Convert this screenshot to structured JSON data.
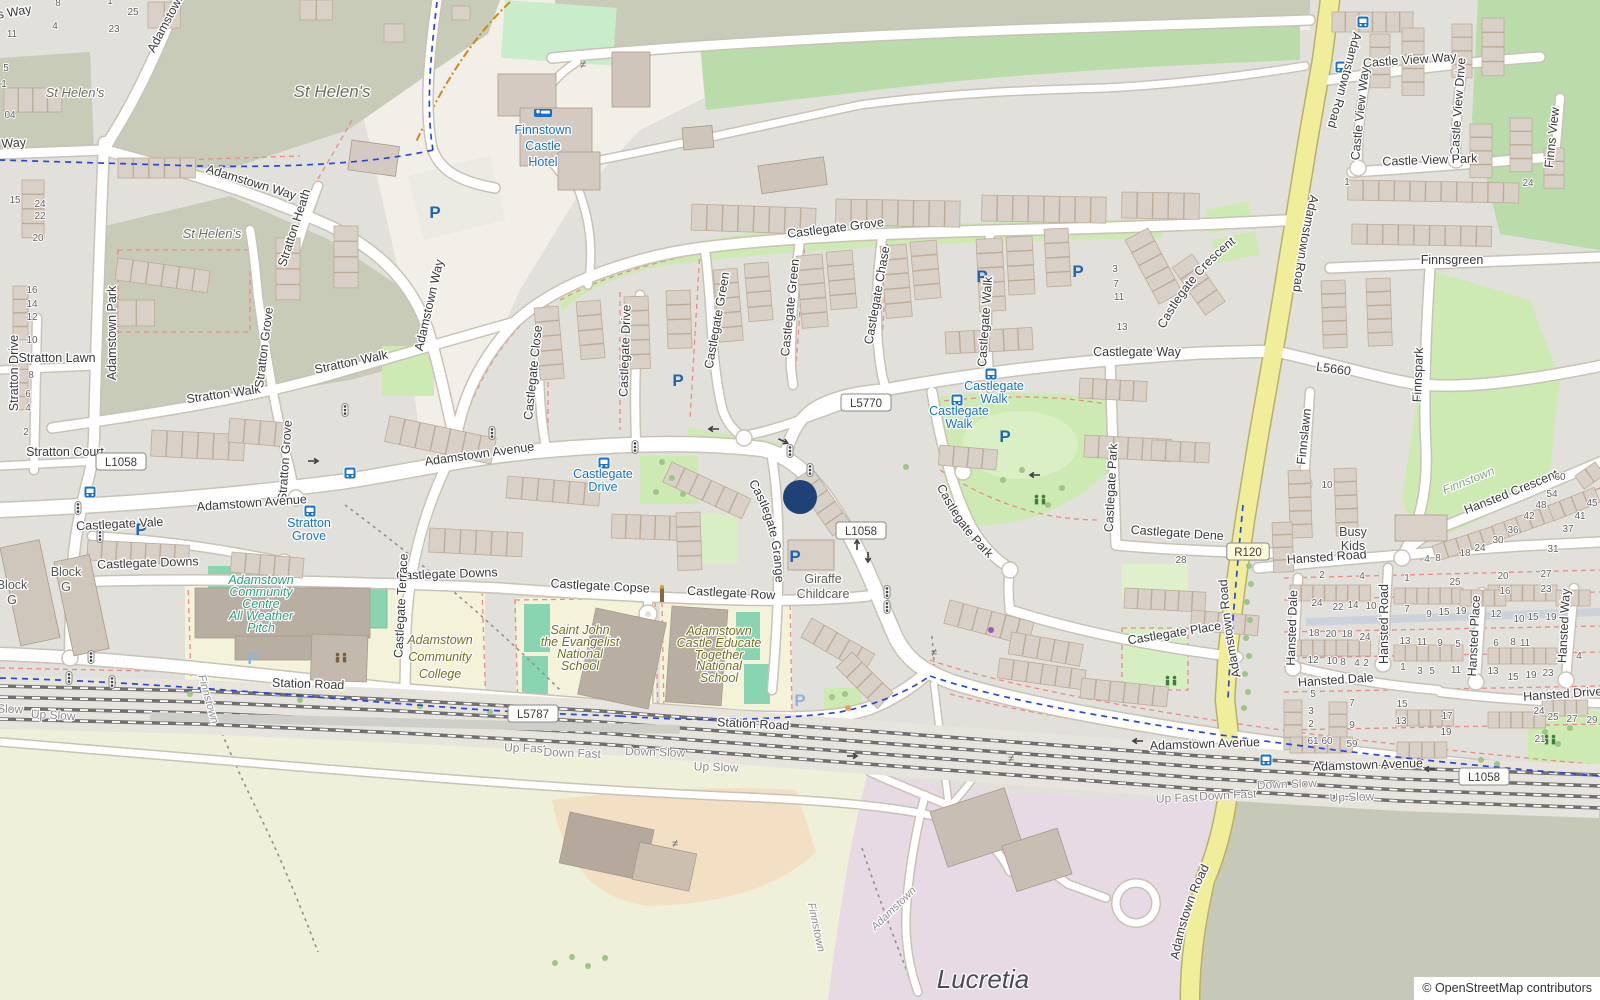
{
  "map": {
    "attribution": "© OpenStreetMap contributors",
    "marker": {
      "x": 800,
      "y": 497,
      "r": 17,
      "color": "#1e4177"
    },
    "colors": {
      "residential": "#e2e0da",
      "base": "#f2efe8",
      "olive_green": "#c7cbb7",
      "wood_green": "#b9dcaa",
      "park_green": "#cdeab3",
      "pitch_teal": "#89d4b1",
      "school_yellow": "#f4f2d9",
      "construction_purple": "#e7dae5",
      "field": "#eff0da",
      "olive_gray": "#c7c9b8",
      "orange_area": "#f3dfc3",
      "road_yellow": "#f1ee9b",
      "building": "#d9d0c8",
      "transit_blue": "#1673c2",
      "hotel_blue": "#1a6fc4",
      "parking_blue": "#2065b0",
      "marker_navy": "#1e4177",
      "red_dash": "#e98b87",
      "cycle_blue": "#2a47d8"
    },
    "road_refs": [
      [
        "L1058",
        121,
        462,
        "w"
      ],
      [
        "L1058",
        861,
        531,
        "w"
      ],
      [
        "L1058",
        1484,
        777,
        "w"
      ],
      [
        "L5770",
        866,
        403,
        "w"
      ],
      [
        "L5787",
        533,
        714,
        "w"
      ],
      [
        "R120",
        1248,
        552,
        "y"
      ]
    ],
    "street_labels": [
      [
        "'s Way",
        14,
        16,
        -10
      ],
      [
        "Way",
        14,
        147,
        -4
      ],
      [
        "Adamstown Way",
        250,
        186,
        17
      ],
      [
        "Adamstown Way",
        176,
        12,
        -62
      ],
      [
        "Adamstown Way",
        433,
        306,
        -77
      ],
      [
        "Stratton Heath",
        298,
        229,
        -72
      ],
      [
        "Stratton Drive",
        18,
        373,
        -90
      ],
      [
        "Stratton Lawn",
        57,
        362,
        0
      ],
      [
        "Stratton Court",
        65,
        456,
        0
      ],
      [
        "Adamstown Park",
        116,
        333,
        -90
      ],
      [
        "Stratton Walk",
        224,
        398,
        -8
      ],
      [
        "Stratton Walk",
        352,
        366,
        -12
      ],
      [
        "Stratton Grove",
        268,
        348,
        -83
      ],
      [
        "Stratton Grove",
        289,
        461,
        -86
      ],
      [
        "Castlegate Grove",
        836,
        232,
        -7
      ],
      [
        "Castlegate Close",
        537,
        373,
        -84
      ],
      [
        "Castlegate Drive",
        629,
        351,
        -88
      ],
      [
        "Castlegate Green",
        721,
        321,
        -80
      ],
      [
        "Castlegate Green",
        794,
        308,
        -84
      ],
      [
        "Castlegate Chase",
        881,
        296,
        -80
      ],
      [
        "Castlegate Walk",
        989,
        322,
        -86
      ],
      [
        "Castlegate Way",
        1137,
        356,
        0
      ],
      [
        "L5660",
        1333,
        373,
        8
      ],
      [
        "Castle View Way",
        1410,
        64,
        -4
      ],
      [
        "Castle View Way",
        1364,
        114,
        -84
      ],
      [
        "Castle View Drive",
        1462,
        107,
        -86
      ],
      [
        "Castle View Park",
        1430,
        164,
        -2
      ],
      [
        "Finns View",
        1556,
        138,
        -84
      ],
      [
        "Finnsgreen",
        1452,
        264,
        0
      ],
      [
        "Finnspark",
        1422,
        375,
        -88
      ],
      [
        "Finnslawn",
        1308,
        437,
        -84
      ],
      [
        "Hansted Road",
        1327,
        561,
        -4
      ],
      [
        "Hansted Road",
        1388,
        624,
        -90
      ],
      [
        "Hansted Dale",
        1296,
        628,
        -88
      ],
      [
        "Hansted Dale",
        1336,
        684,
        -4
      ],
      [
        "Hansted Place",
        1478,
        636,
        -87
      ],
      [
        "Hansted Way",
        1568,
        626,
        -87
      ],
      [
        "Hansted Drive",
        1563,
        698,
        -4
      ],
      [
        "Castlegate Vale",
        120,
        528,
        -3
      ],
      [
        "Castlegate Downs",
        148,
        567,
        -2
      ],
      [
        "Castlegate Downs",
        447,
        578,
        -2
      ],
      [
        "Castlegate Terrace",
        405,
        606,
        -87
      ],
      [
        "Castlegate Copse",
        600,
        590,
        3
      ],
      [
        "Castlegate Row",
        731,
        597,
        3
      ],
      [
        "Castlegate Park",
        1115,
        488,
        -87
      ],
      [
        "Castlegate Dene",
        1177,
        537,
        4
      ],
      [
        "Castlegate Place",
        1175,
        637,
        -9
      ],
      [
        "Adamstown Avenue",
        252,
        507,
        -4
      ],
      [
        "Adamstown Avenue",
        480,
        458,
        -8
      ],
      [
        "Adamstown Avenue",
        1205,
        748,
        -2
      ],
      [
        "Adamstown Avenue",
        1368,
        769,
        -2
      ],
      [
        "Station Road",
        308,
        688,
        2
      ],
      [
        "Station Road",
        753,
        728,
        3
      ]
    ],
    "curved_labels": [
      [
        "Castlegate Grange",
        "M 735,464 C 762,498 777,534 776,606"
      ],
      [
        "Castlegate Crescent",
        "M 1160,338 C 1180,296 1207,263 1244,237"
      ],
      [
        "Castlegate Park",
        "M 928,468 C 947,512 968,543 1004,572"
      ],
      [
        "Hansted Crescent",
        "M 1424,530 C 1492,505 1549,482 1600,459"
      ],
      [
        "Adamstown Road",
        "M 1355,26 C 1346,62 1337,96 1326,132"
      ],
      [
        "Adamstown Road",
        "M 1313,184 C 1303,224 1296,263 1292,302"
      ],
      [
        "Adamstown Road",
        "M 1241,678 C 1233,642 1229,611 1227,578"
      ],
      [
        "Adamstown Road",
        "M 1177,970 C 1183,928 1195,893 1214,858"
      ]
    ],
    "place_labels": [
      [
        "St Helen's",
        75,
        97,
        0,
        13,
        "#6d6d62"
      ],
      [
        "St Helen's",
        332,
        97,
        0,
        17,
        "#6d6d62"
      ],
      [
        "St Helen's",
        212,
        238,
        0,
        13,
        "#6d6d62"
      ],
      [
        "Finnstown",
        1470,
        484,
        -22,
        12,
        "#8ba386"
      ],
      [
        "Finnstown",
        205,
        700,
        74,
        11,
        "#8c8c8c"
      ],
      [
        "Adamstown",
        896,
        911,
        -44,
        11,
        "#8c8c8c"
      ],
      [
        "Finnstown",
        813,
        928,
        78,
        11,
        "#8c8c8c"
      ],
      [
        "Lucretia",
        983,
        988,
        0,
        26,
        "#4a4a58"
      ]
    ],
    "poi_labels": [
      {
        "lines": [
          "Finnstown",
          "Castle",
          "Hotel"
        ],
        "x": 543,
        "ys": [
          134,
          150,
          166
        ],
        "color": "#1a6fc4",
        "icon": "bed",
        "ix": 543,
        "iy": 114
      },
      {
        "lines": [
          "Giraffe",
          "Childcare"
        ],
        "x": 823,
        "ys": [
          583,
          598
        ],
        "color": "#5d5d55"
      },
      {
        "lines": [
          "Busy",
          "Kids"
        ],
        "x": 1353,
        "ys": [
          536,
          550
        ],
        "color": "#454545"
      },
      {
        "lines": [
          "Block",
          "G"
        ],
        "x": 12,
        "ys": [
          589,
          604
        ],
        "color": "#555555"
      },
      {
        "lines": [
          "Block",
          "G"
        ],
        "x": 66,
        "ys": [
          576,
          591
        ],
        "color": "#555555"
      }
    ],
    "school_labels": [
      {
        "lines": [
          "Adamstown",
          "Community",
          "College"
        ],
        "x": 440,
        "ys": [
          644,
          661,
          678
        ],
        "color": "#71711f"
      },
      {
        "lines": [
          "Saint John",
          "the Evangelist",
          "National",
          "School"
        ],
        "x": 580,
        "ys": [
          634,
          646,
          658,
          670
        ],
        "color": "#71711f"
      },
      {
        "lines": [
          "Adamstown",
          "Castle Educate",
          "Together",
          "National",
          "School"
        ],
        "x": 719,
        "ys": [
          635,
          647,
          659,
          670,
          682
        ],
        "color": "#71711f"
      },
      {
        "lines": [
          "Adamstown",
          "Community",
          "Centre",
          "All Weather",
          "Pitch"
        ],
        "x": 261,
        "ys": [
          584,
          596,
          608,
          620,
          632
        ],
        "color": "#2f9f7f"
      }
    ],
    "transit_stops": [
      {
        "lines": [
          "Castlegate",
          "Walk"
        ],
        "x": 994,
        "ys": [
          390,
          403
        ],
        "icon": [
          991,
          374
        ]
      },
      {
        "lines": [
          "Castlegate",
          "Walk"
        ],
        "x": 959,
        "ys": [
          415,
          428
        ],
        "icon": [
          957,
          400
        ]
      },
      {
        "lines": [
          "Castlegate",
          "Drive"
        ],
        "x": 603,
        "ys": [
          478,
          491
        ],
        "icon": [
          604,
          463
        ]
      },
      {
        "lines": [
          "Stratton",
          "Grove"
        ],
        "x": 309,
        "ys": [
          527,
          540
        ],
        "icon": [
          310,
          511
        ]
      }
    ],
    "bus_icons": [
      [
        350,
        473
      ],
      [
        90,
        492
      ],
      [
        1363,
        22
      ],
      [
        1341,
        67
      ],
      [
        1266,
        760
      ]
    ],
    "railway_labels": [
      [
        "Up Fast",
        525,
        752,
        2
      ],
      [
        "Down Fast",
        572,
        757,
        2
      ],
      [
        "Down Slow",
        655,
        756,
        2
      ],
      [
        "Up Slow",
        716,
        771,
        2
      ],
      [
        "Slow",
        10,
        713,
        2
      ],
      [
        "Up Slow",
        53,
        719,
        3
      ],
      [
        "Up Fast",
        1177,
        802,
        -2
      ],
      [
        "Down Fast",
        1228,
        799,
        -3
      ],
      [
        "Down Slow",
        1287,
        788,
        -2
      ],
      [
        "Up Slow",
        1352,
        801,
        -2
      ]
    ],
    "house_numbers": [
      [
        "8",
        58,
        6
      ],
      [
        "1",
        110,
        4
      ],
      [
        "25",
        133,
        15
      ],
      [
        "4",
        55,
        29
      ],
      [
        "23",
        114,
        32
      ],
      [
        "11",
        12,
        37
      ],
      [
        "5",
        6,
        71
      ],
      [
        "1",
        4,
        87
      ],
      [
        "04",
        10,
        118
      ],
      [
        "15",
        15,
        203
      ],
      [
        "24",
        40,
        207
      ],
      [
        "22",
        40,
        219
      ],
      [
        "20",
        38,
        241
      ],
      [
        "16",
        32,
        293
      ],
      [
        "14",
        32,
        307
      ],
      [
        "12",
        32,
        320
      ],
      [
        "10",
        32,
        343
      ],
      [
        "8",
        31,
        378
      ],
      [
        "6",
        28,
        397
      ],
      [
        "4",
        28,
        411
      ],
      [
        "2",
        26,
        435
      ],
      [
        "1",
        1347,
        185
      ],
      [
        "24",
        1528,
        186
      ],
      [
        "3",
        1115,
        272
      ],
      [
        "7",
        1116,
        287
      ],
      [
        "11",
        1119,
        300
      ],
      [
        "13",
        1122,
        330
      ],
      [
        "28",
        1181,
        563
      ],
      [
        "10",
        1327,
        488
      ],
      [
        "60",
        1560,
        480
      ],
      [
        "54",
        1552,
        497
      ],
      [
        "45",
        1592,
        506
      ],
      [
        "48",
        1541,
        508
      ],
      [
        "42",
        1529,
        519
      ],
      [
        "41",
        1580,
        519
      ],
      [
        "37",
        1568,
        532
      ],
      [
        "36",
        1513,
        533
      ],
      [
        "30",
        1498,
        543
      ],
      [
        "31",
        1553,
        552
      ],
      [
        "24",
        1480,
        551
      ],
      [
        "18",
        1465,
        556
      ],
      [
        "8",
        1438,
        561
      ],
      [
        "4",
        1427,
        562
      ],
      [
        "2",
        1322,
        578
      ],
      [
        "4",
        1362,
        579
      ],
      [
        "1",
        1407,
        581
      ],
      [
        "25",
        1455,
        585
      ],
      [
        "20",
        1503,
        579
      ],
      [
        "27",
        1546,
        577
      ],
      [
        "16",
        1505,
        594
      ],
      [
        "23",
        1546,
        592
      ],
      [
        "24",
        1317,
        606
      ],
      [
        "22",
        1338,
        610
      ],
      [
        "14",
        1353,
        608
      ],
      [
        "10",
        1371,
        609
      ],
      [
        "7",
        1407,
        612
      ],
      [
        "9",
        1429,
        617
      ],
      [
        "15",
        1444,
        615
      ],
      [
        "19",
        1461,
        614
      ],
      [
        "12",
        1496,
        617
      ],
      [
        "10",
        1519,
        622
      ],
      [
        "15",
        1533,
        620
      ],
      [
        "19",
        1551,
        620
      ],
      [
        "18",
        1314,
        636
      ],
      [
        "20",
        1331,
        637
      ],
      [
        "18",
        1347,
        637
      ],
      [
        "24",
        1365,
        640
      ],
      [
        "13",
        1405,
        644
      ],
      [
        "11",
        1422,
        645
      ],
      [
        "9",
        1440,
        646
      ],
      [
        "5",
        1458,
        647
      ],
      [
        "6",
        1496,
        646
      ],
      [
        "8",
        1513,
        645
      ],
      [
        "11",
        1525,
        646
      ],
      [
        "12",
        1313,
        663
      ],
      [
        "10",
        1332,
        664
      ],
      [
        "8",
        1343,
        665
      ],
      [
        "4",
        1357,
        666
      ],
      [
        "2",
        1366,
        666
      ],
      [
        "1",
        1403,
        670
      ],
      [
        "3",
        1420,
        674
      ],
      [
        "5",
        1432,
        674
      ],
      [
        "11",
        1456,
        673
      ],
      [
        "13",
        1493,
        674
      ],
      [
        "15",
        1513,
        680
      ],
      [
        "19",
        1531,
        678
      ],
      [
        "23",
        1548,
        676
      ],
      [
        "5",
        1313,
        697
      ],
      [
        "3",
        1311,
        714
      ],
      [
        "2",
        1311,
        727
      ],
      [
        "7",
        1352,
        706
      ],
      [
        "9",
        1352,
        728
      ],
      [
        "15",
        1402,
        707
      ],
      [
        "13",
        1401,
        724
      ],
      [
        "17",
        1447,
        719
      ],
      [
        "19",
        1446,
        735
      ],
      [
        "61",
        1313,
        744
      ],
      [
        "60",
        1327,
        744
      ],
      [
        "59",
        1352,
        747
      ],
      [
        "24",
        1539,
        714
      ],
      [
        "25",
        1553,
        720
      ],
      [
        "27",
        1572,
        722
      ],
      [
        "29",
        1592,
        723
      ],
      [
        "21",
        1540,
        742
      ],
      [
        "4",
        1579,
        659
      ]
    ],
    "parking": [
      [
        435,
        213,
        0
      ],
      [
        678,
        381,
        0
      ],
      [
        982,
        277,
        0
      ],
      [
        1078,
        272,
        0
      ],
      [
        1005,
        437,
        0
      ],
      [
        141,
        530,
        0
      ],
      [
        795,
        557,
        0
      ],
      [
        253,
        659,
        1
      ],
      [
        800,
        701,
        1
      ]
    ],
    "signals": [
      [
        492,
        433
      ],
      [
        635,
        447
      ],
      [
        790,
        451
      ],
      [
        810,
        470
      ],
      [
        78,
        508
      ],
      [
        100,
        536
      ],
      [
        91,
        657
      ],
      [
        69,
        678
      ],
      [
        112,
        682
      ],
      [
        887,
        592
      ],
      [
        887,
        607
      ],
      [
        345,
        410
      ]
    ],
    "arrows": [
      [
        313,
        461,
        0
      ],
      [
        530,
        450,
        180
      ],
      [
        714,
        429,
        180
      ],
      [
        783,
        441,
        25
      ],
      [
        1035,
        475,
        180
      ],
      [
        857,
        545,
        -90
      ],
      [
        868,
        557,
        90
      ],
      [
        1138,
        741,
        180
      ],
      [
        1430,
        769,
        180
      ],
      [
        852,
        756,
        0
      ]
    ],
    "gates": [
      [
        583,
        64
      ],
      [
        675,
        843
      ],
      [
        1011,
        758
      ],
      [
        934,
        652
      ]
    ],
    "bollard": [
      662,
      596
    ],
    "small_dots": [
      [
        848,
        708,
        "#e8a25e"
      ],
      [
        991,
        630,
        "#9b59b6"
      ]
    ],
    "playgrounds": [
      [
        341,
        658,
        "#7b5d3f"
      ],
      [
        1171,
        681,
        "#3e7d3e"
      ],
      [
        1040,
        500,
        "#3e7d3e"
      ],
      [
        1550,
        740,
        "#3e7d3e"
      ]
    ]
  }
}
